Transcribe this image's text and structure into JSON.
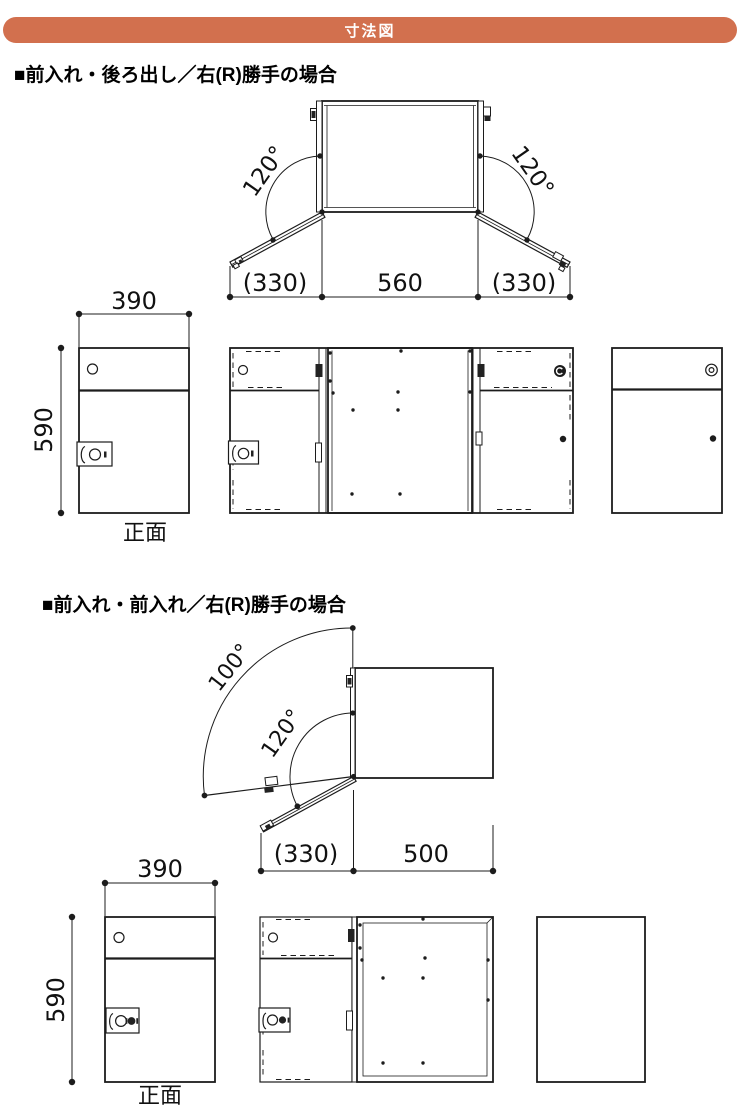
{
  "colors": {
    "accent_bar": "#d2704e",
    "line": "#1c1c1c",
    "text": "#111111"
  },
  "header": {
    "title": "寸法図"
  },
  "section1": {
    "title": "■前入れ・後ろ出し／右(R)勝手の場合",
    "top_view": {
      "left_angle": "120°",
      "right_angle": "120°",
      "dim_left": "(330)",
      "dim_center": "560",
      "dim_right": "(330)"
    },
    "front_view": {
      "width_dim": "390",
      "height_dim": "590",
      "caption": "正面"
    }
  },
  "section2": {
    "title": "■前入れ・前入れ／右(R)勝手の場合",
    "top_view": {
      "upper_angle": "100°",
      "lower_angle": "120°",
      "dim_left": "(330)",
      "dim_right": "500"
    },
    "front_view": {
      "width_dim": "390",
      "height_dim": "590",
      "caption": "正面"
    }
  }
}
